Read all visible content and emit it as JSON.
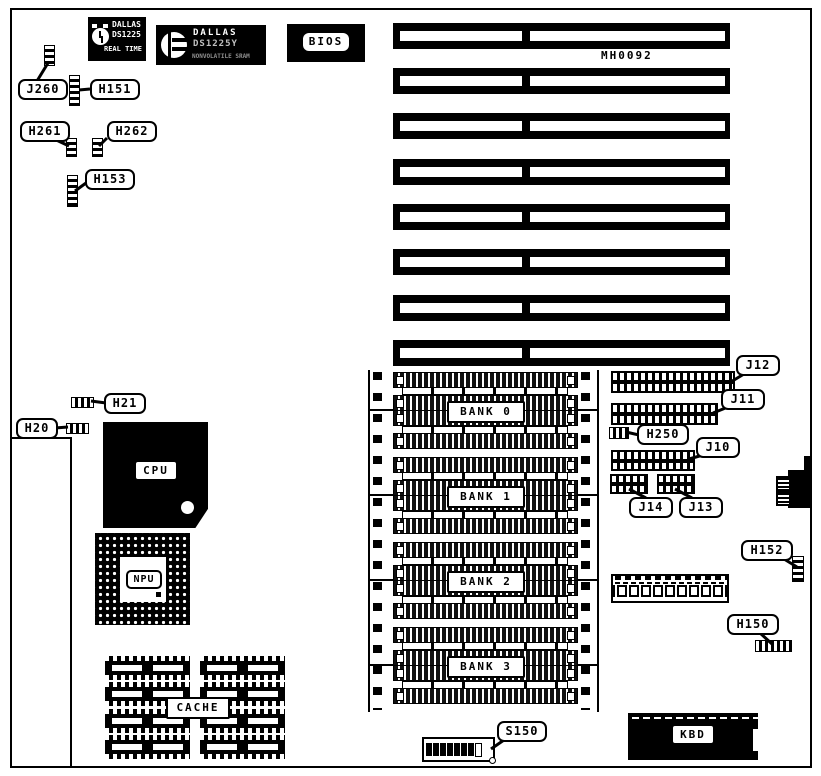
{
  "diagram": {
    "code": "MH0092",
    "board_color": "#000000",
    "background_color": "#ffffff"
  },
  "chips": {
    "rtc": {
      "icon": "alarm-clock-icon",
      "name": "DALLAS",
      "part": "DS1225",
      "subtitle": "REAL TIME"
    },
    "sram": {
      "icon": "dallas-logo-icon",
      "name": "DALLAS",
      "part": "DS1225Y",
      "subtitle": "NONVOLATILE SRAM"
    },
    "bios_label": "BIOS",
    "cpu_label": "CPU",
    "npu_label": "NPU",
    "cache_label": "CACHE",
    "kbd_label": "KBD"
  },
  "banks": {
    "bank0": "BANK 0",
    "bank1": "BANK 1",
    "bank2": "BANK 2",
    "bank3": "BANK 3"
  },
  "callouts": {
    "j260": "J260",
    "h151": "H151",
    "h261": "H261",
    "h262": "H262",
    "h153": "H153",
    "h21": "H21",
    "h20": "H20",
    "h250": "H250",
    "j12": "J12",
    "j11": "J11",
    "j10": "J10",
    "j14": "J14",
    "j13": "J13",
    "h152": "H152",
    "h150": "H150",
    "s150": "S150"
  },
  "isa_slots": {
    "count": 8
  },
  "memory": {
    "bank_count": 4,
    "sockets_per_bank": 4
  },
  "dip_switch": {
    "positions": 8,
    "closed": 7,
    "open": 1
  }
}
